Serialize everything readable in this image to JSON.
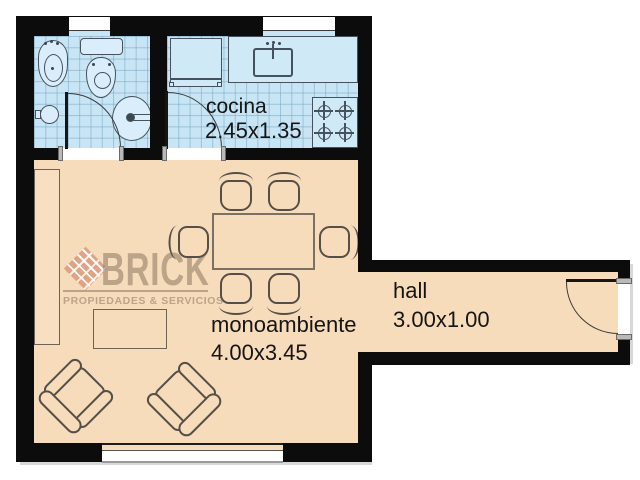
{
  "watermark": {
    "brand": "BRICK",
    "tagline": "PROPIEDADES & SERVICIOS"
  },
  "rooms": {
    "kitchen": {
      "label": "cocina",
      "dims": "2.45x1.35"
    },
    "studio": {
      "label": "monoambiente",
      "dims": "4.00x3.45"
    },
    "hall": {
      "label": "hall",
      "dims": "3.00x1.00"
    }
  },
  "fixtures": {
    "bathroom": [
      "bidet",
      "toilet",
      "washbasin",
      "floor-drain",
      "door"
    ],
    "kitchen": [
      "fridge",
      "counter",
      "sink",
      "stove-4-burners",
      "door",
      "window"
    ],
    "studio": [
      "wardrobe",
      "coffee-table",
      "dining-table",
      "six-chairs",
      "two-armchairs",
      "window"
    ],
    "hall": [
      "entrance-door"
    ]
  },
  "colors": {
    "wall": "#0c0c0c",
    "wet": "#c7e5f4",
    "dry": "#f7dcbc",
    "wmk": "rgba(128,108,82,0.5)"
  }
}
